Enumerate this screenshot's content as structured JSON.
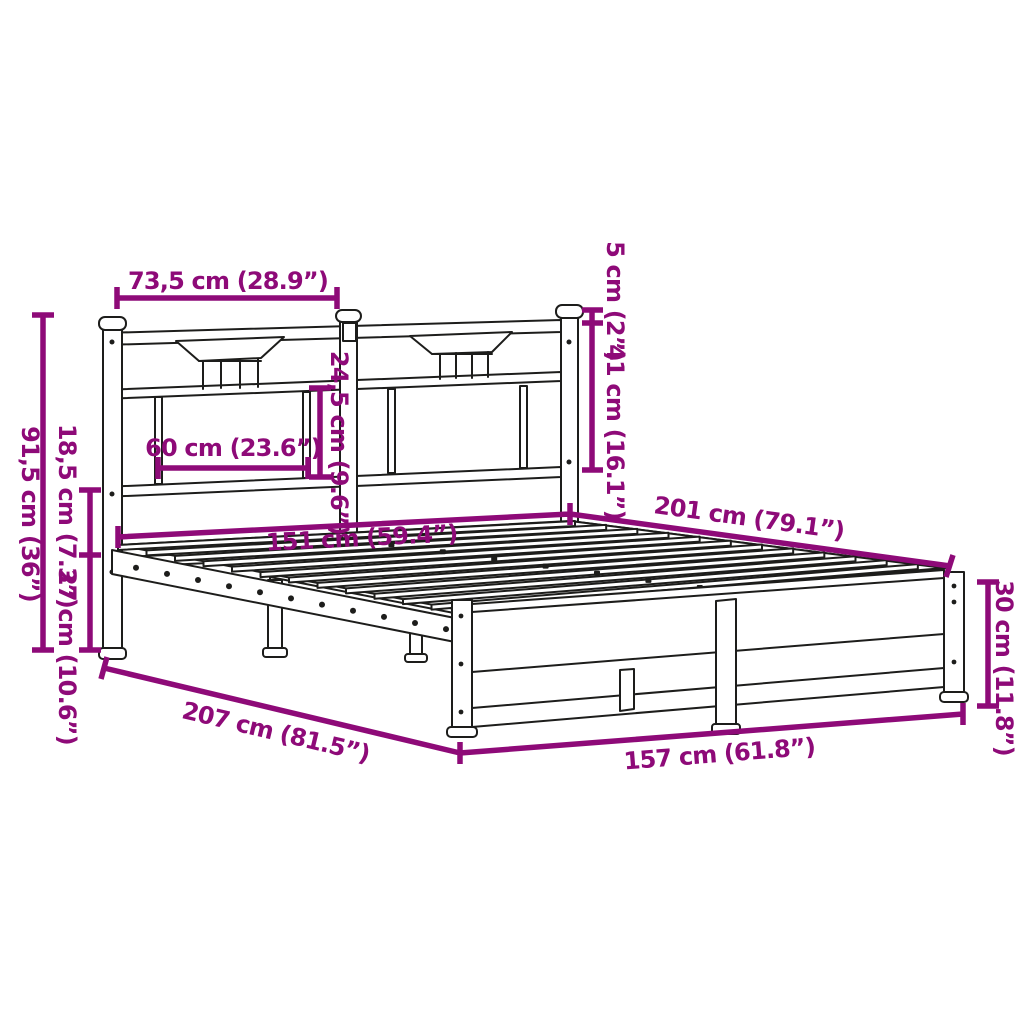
{
  "diagram": {
    "type": "product-dimension-diagram",
    "subject": "metal bed frame with headboard and footboard, slatted base, no mattress",
    "accent_color": "#8E0A78",
    "line_color": "#1d1d1b",
    "background_color": "#ffffff",
    "units": [
      "cm",
      "inches"
    ],
    "dimensions": {
      "headboard_section_width": "73,5 cm (28.9”)",
      "post_cap_height": "5 cm (2”)",
      "headboard_upper_height": "41 cm (16.1”)",
      "headboard_panel_height": "24,5 cm (9.6”)",
      "headboard_panel_width": "60 cm (23.6”)",
      "headboard_total_height": "91,5 cm (36”)",
      "under_rail_gap_height": "18,5 cm (7.3”)",
      "ground_clearance": "27 cm (10.6”)",
      "slat_base_width": "151 cm (59.4”)",
      "slat_base_length": "201 cm (79.1”)",
      "footboard_height": "30 cm (11.8”)",
      "total_length": "207 cm (81.5”)",
      "total_width": "157 cm (61.8”)"
    }
  }
}
